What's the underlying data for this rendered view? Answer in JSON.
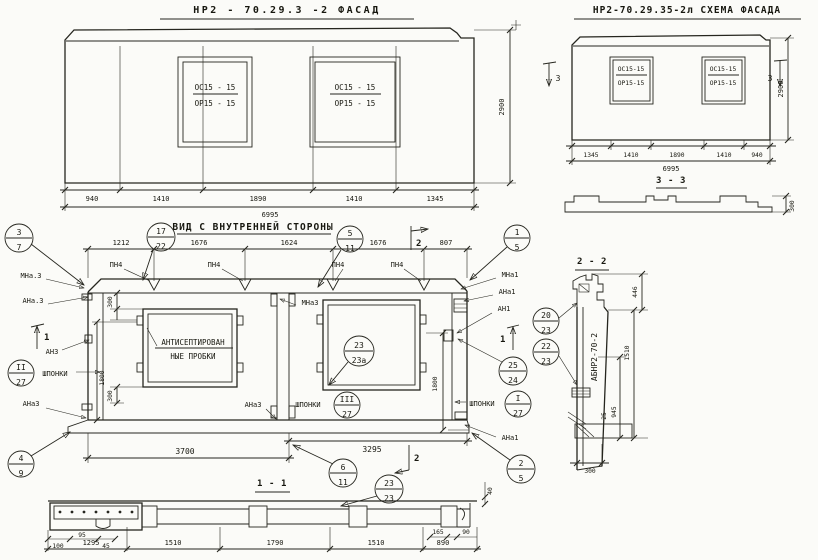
{
  "drawing": {
    "facade": {
      "title": "НР2 - 70.29.3 -2   ФАСАД",
      "window_top": "ОС15 - 15",
      "window_bottom": "ОР15 - 15",
      "dims": [
        "940",
        "1410",
        "1890",
        "1410",
        "1345"
      ],
      "total": "6995",
      "height": "2900"
    },
    "schema": {
      "title": "НР2-70.29.35-2л  СХЕМА ФАСАДА",
      "window_top": "ОС15-15",
      "window_bottom": "ОР15-15",
      "dims": [
        "1345",
        "1410",
        "1890",
        "1410",
        "940"
      ],
      "total": "6995",
      "height": "2900",
      "profile_height": "300",
      "section_title": "3 - 3"
    },
    "interior": {
      "title": "ВИД С ВНУТРЕННЕЙ СТОРОНЫ",
      "dims_top": [
        "1212",
        "1676",
        "1624",
        "1676",
        "807"
      ],
      "joint_label": "ПН4",
      "plugs_line1": "АНТИСЕПТИРОВАН",
      "plugs_line2": "НЫЕ ПРОБКИ",
      "dim_300": "300",
      "dim_1800": "1800",
      "dim_3700": "3700",
      "dim_3295": "3295",
      "dim_40": "40",
      "labels": {
        "mna_3": "МНа.3",
        "ana_3": "АНа.3",
        "an3": "АН3",
        "ana3": "АНа3",
        "mna3": "МНа3",
        "mna1": "МНа1",
        "ana1": "АНа1",
        "an1": "АН1",
        "shponki": "ШПОНКИ"
      },
      "marks": {
        "m1": "1",
        "m2": "2",
        "m3": "3"
      }
    },
    "callouts": {
      "c3_7": [
        "3",
        "7"
      ],
      "c17_22": [
        "17",
        "22"
      ],
      "c5_11": [
        "5",
        "11"
      ],
      "c1_5": [
        "1",
        "5"
      ],
      "c2_27": [
        "II",
        "27"
      ],
      "c4_9": [
        "4",
        "9"
      ],
      "c23_23a": [
        "23",
        "23а"
      ],
      "c3_27": [
        "III",
        "27"
      ],
      "c20_23": [
        "20",
        "23"
      ],
      "c22_23": [
        "22",
        "23"
      ],
      "c25_24": [
        "25",
        "24"
      ],
      "c1_27": [
        "I",
        "27"
      ],
      "c2_5": [
        "2",
        "5"
      ],
      "c6_11": [
        "6",
        "11"
      ],
      "c23_23": [
        "23",
        "23"
      ]
    },
    "section_1_1": {
      "title": "1 - 1",
      "dims_left": [
        "100",
        "95",
        "45"
      ],
      "dims": [
        "1295",
        "1510",
        "1790",
        "1510",
        "890"
      ],
      "dims_right": [
        "165",
        "90"
      ]
    },
    "section_2_2": {
      "title": "2 - 2",
      "stamp": "АБНР2-70-2",
      "d446": "446",
      "d1510": "1510",
      "d945": "945",
      "d25": "25",
      "d300": "300"
    }
  }
}
